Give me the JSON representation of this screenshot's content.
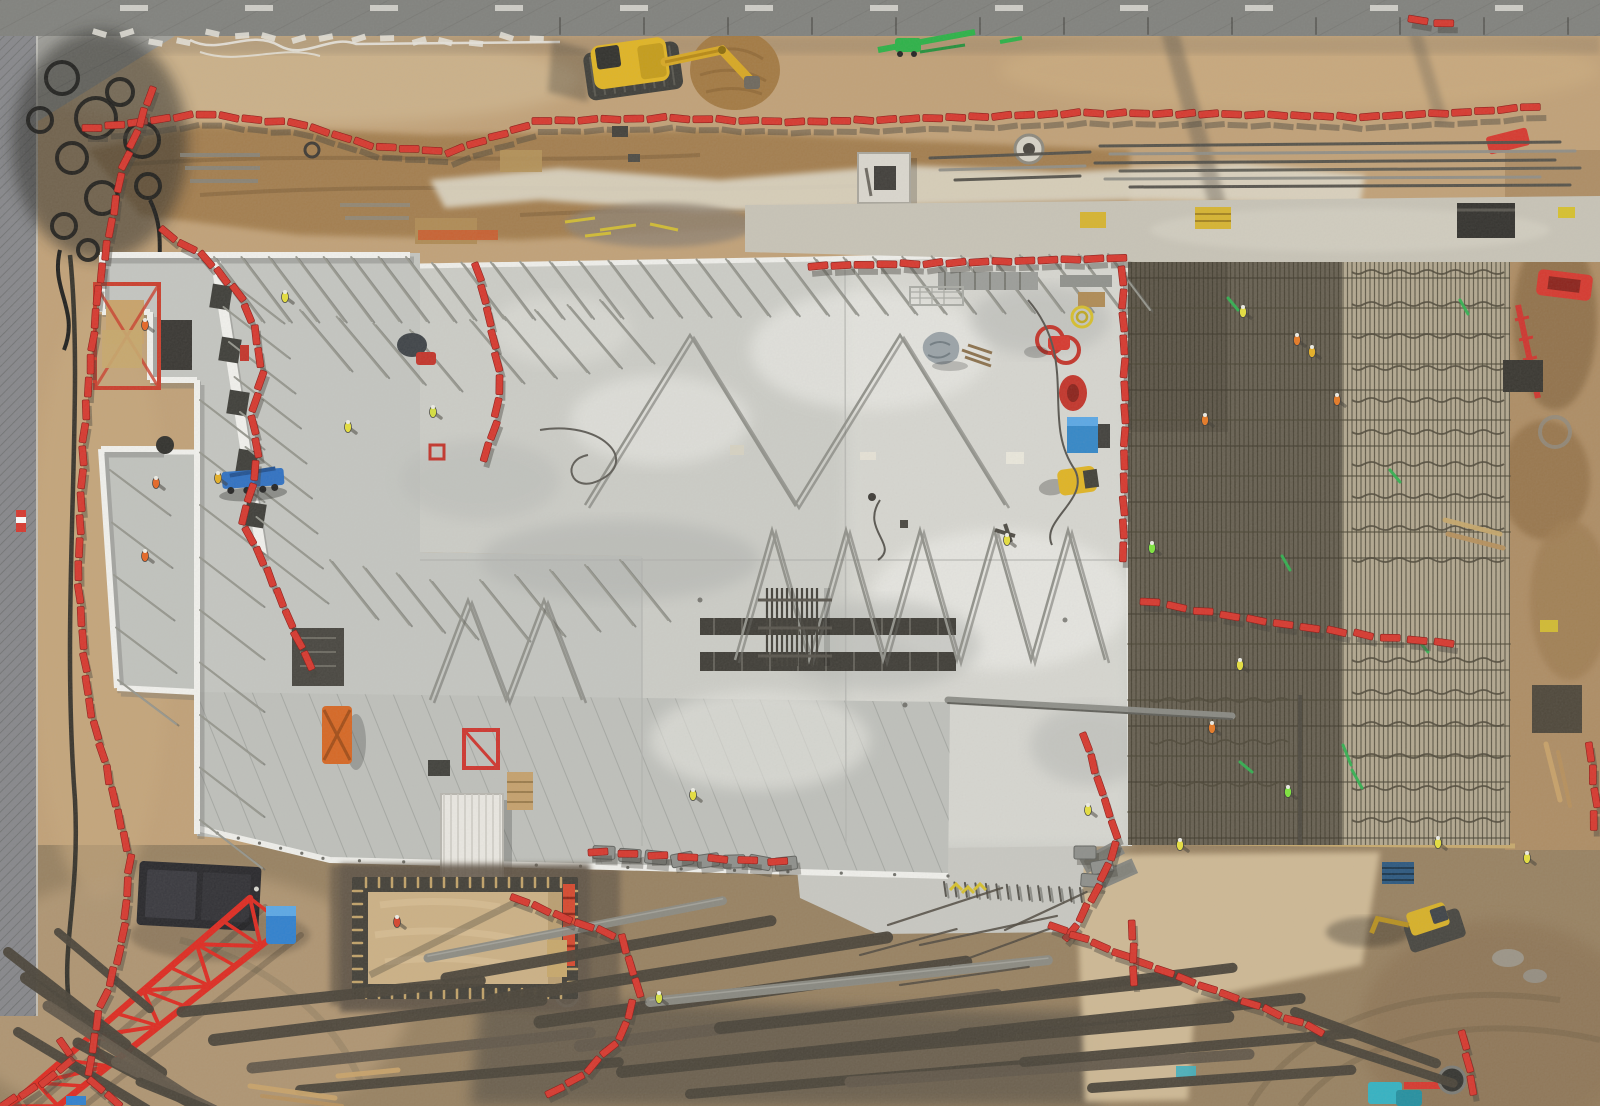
{
  "scene": {
    "title": "Aerial drone view of a construction site",
    "type": "top-down photograph",
    "width": 1600,
    "height": 1106,
    "elements": [
      "road",
      "perimeter-fence",
      "dirt-groundworks",
      "excavation-trench",
      "yellow-excavator",
      "black-cable-coils",
      "red-barrier-chains",
      "precast-building-shell",
      "prop-braces",
      "fresh-concrete-slab",
      "rebar-mesh-pour-area",
      "white-container",
      "blue-telehandler",
      "crawler-crane-boom",
      "foundation-pit-formwork",
      "rebar-stockpiles",
      "mini-excavator",
      "workers-hi-vis"
    ]
  },
  "colors": {
    "dirt_base": "#c2a176",
    "dirt_dark": "#9c7a4e",
    "dirt_brown": "#8a6a42",
    "mud": "#6a5d4b",
    "sand_light": "#d7c19a",
    "chalk": "#ded8c6",
    "road": "#7f807c",
    "fence": "#85868a",
    "slab": "#cdcec8",
    "slab_light": "#e6e6e0",
    "building_floor": "#c5c7c2",
    "canopy": "#bfc1bc",
    "wall_white": "#f4f4f0",
    "mesh_base": "#8a8171",
    "mesh_line": "#4b4534",
    "mesh_dark": "#2f2a1e",
    "mesh_light": "#cfc3a4",
    "barrier_red": "#d8342a",
    "crane_red": "#e0261c",
    "machine_yellow": "#e2b51f",
    "green": "#2eb24e",
    "blue": "#2b6fc4",
    "teal": "#2fb3c4",
    "dark": "#2e2c28",
    "steel": "#8a8a82",
    "shadow": "#3e3b35"
  },
  "road": {
    "dash_y": 5,
    "dash_xs": [
      120,
      245,
      370,
      495,
      620,
      745,
      870,
      995,
      1120,
      1245,
      1370,
      1495
    ]
  },
  "chains": [
    {
      "name": "perimeter-top",
      "sh": [
        6,
        10
      ],
      "pts": [
        [
          92,
          128
        ],
        [
          200,
          114
        ],
        [
          300,
          124
        ],
        [
          372,
          146
        ],
        [
          450,
          152
        ],
        [
          540,
          121
        ],
        [
          660,
          118
        ],
        [
          800,
          122
        ],
        [
          940,
          118
        ],
        [
          1080,
          113
        ],
        [
          1220,
          114
        ],
        [
          1360,
          117
        ],
        [
          1470,
          112
        ],
        [
          1532,
          107
        ]
      ]
    },
    {
      "name": "perimeter-left",
      "pts": [
        [
          150,
          96
        ],
        [
          122,
          170
        ],
        [
          98,
          290
        ],
        [
          84,
          430
        ],
        [
          78,
          580
        ],
        [
          88,
          700
        ],
        [
          112,
          790
        ],
        [
          130,
          860
        ],
        [
          122,
          946
        ],
        [
          98,
          1016
        ],
        [
          88,
          1078
        ],
        [
          116,
          1102
        ]
      ]
    },
    {
      "name": "slab-north-east",
      "pts": [
        [
          818,
          266
        ],
        [
          980,
          262
        ],
        [
          1122,
          258
        ],
        [
          1125,
          400
        ],
        [
          1123,
          556
        ]
      ]
    },
    {
      "name": "slab-inner-west",
      "pts": [
        [
          478,
          272
        ],
        [
          492,
          330
        ],
        [
          500,
          380
        ],
        [
          494,
          430
        ],
        [
          486,
          452
        ]
      ]
    },
    {
      "name": "building-west",
      "pts": [
        [
          168,
          234
        ],
        [
          205,
          258
        ],
        [
          240,
          295
        ],
        [
          255,
          330
        ],
        [
          262,
          375
        ],
        [
          252,
          415
        ],
        [
          258,
          455
        ],
        [
          250,
          495
        ],
        [
          242,
          522
        ],
        [
          262,
          560
        ],
        [
          282,
          602
        ],
        [
          300,
          645
        ],
        [
          318,
          680
        ]
      ]
    },
    {
      "name": "slab-south",
      "step": 30,
      "pts": [
        [
          598,
          852
        ],
        [
          700,
          858
        ],
        [
          788,
          862
        ]
      ]
    },
    {
      "name": "slab-se-corner",
      "pts": [
        [
          1086,
          742
        ],
        [
          1102,
          792
        ],
        [
          1118,
          840
        ],
        [
          1096,
          892
        ],
        [
          1066,
          940
        ]
      ]
    },
    {
      "name": "bottom-diagonal",
      "pts": [
        [
          1058,
          928
        ],
        [
          1130,
          958
        ],
        [
          1200,
          985
        ],
        [
          1268,
          1010
        ],
        [
          1322,
          1032
        ]
      ]
    },
    {
      "name": "bottom-right-vertical",
      "pts": [
        [
          1464,
          1040
        ],
        [
          1470,
          1074
        ],
        [
          1475,
          1104
        ]
      ]
    },
    {
      "name": "mesh-mid",
      "step": 27,
      "pts": [
        [
          1150,
          602
        ],
        [
          1230,
          616
        ],
        [
          1310,
          628
        ],
        [
          1392,
          638
        ],
        [
          1470,
          645
        ]
      ]
    },
    {
      "name": "pit-east",
      "pts": [
        [
          520,
          900
        ],
        [
          575,
          922
        ],
        [
          622,
          938
        ],
        [
          638,
          988
        ],
        [
          620,
          1038
        ],
        [
          584,
          1074
        ],
        [
          546,
          1096
        ]
      ]
    },
    {
      "name": "corner-bottom-left",
      "pts": [
        [
          8,
          1102
        ],
        [
          42,
          1084
        ],
        [
          72,
          1060
        ],
        [
          54,
          1028
        ]
      ]
    },
    {
      "name": "top-right-single",
      "step": 26,
      "pts": [
        [
          1418,
          20
        ],
        [
          1450,
          24
        ]
      ]
    },
    {
      "name": "right-edge",
      "pts": [
        [
          1590,
          752
        ],
        [
          1596,
          800
        ],
        [
          1592,
          836
        ]
      ]
    },
    {
      "name": "apron-vertical",
      "pts": [
        [
          1132,
          930
        ],
        [
          1134,
          962
        ],
        [
          1133,
          992
        ]
      ]
    }
  ],
  "gray_barriers": [
    [
      604,
      852
    ],
    [
      630,
      855
    ],
    [
      656,
      857
    ],
    [
      682,
      859
    ],
    [
      708,
      860
    ],
    [
      734,
      861
    ],
    [
      760,
      862
    ],
    [
      786,
      863
    ],
    [
      1085,
      852
    ],
    [
      1102,
      866
    ],
    [
      1092,
      880
    ]
  ],
  "workers": [
    [
      285,
      297,
      "#e8e13a"
    ],
    [
      348,
      427,
      "#e8e13a"
    ],
    [
      433,
      412,
      "#d8e23c"
    ],
    [
      145,
      325,
      "#e86420"
    ],
    [
      156,
      483,
      "#e86420"
    ],
    [
      145,
      556,
      "#e86420"
    ],
    [
      218,
      478,
      "#e8b020"
    ],
    [
      693,
      795,
      "#e8e13a"
    ],
    [
      1007,
      540,
      "#e8e13a"
    ],
    [
      659,
      998,
      "#d8e23c"
    ],
    [
      397,
      922,
      "#d84028"
    ],
    [
      1243,
      312,
      "#e8e13a"
    ],
    [
      1297,
      340,
      "#e87820"
    ],
    [
      1312,
      352,
      "#e8b020"
    ],
    [
      1205,
      420,
      "#e87820"
    ],
    [
      1152,
      548,
      "#7ce838"
    ],
    [
      1240,
      665,
      "#e8e13a"
    ],
    [
      1212,
      728,
      "#e87820"
    ],
    [
      1288,
      792,
      "#7ce838"
    ],
    [
      1180,
      845,
      "#e8e13a"
    ],
    [
      1438,
      843,
      "#e8e13a"
    ],
    [
      1527,
      858,
      "#e8e13a"
    ],
    [
      1337,
      400,
      "#e87820"
    ],
    [
      1088,
      810,
      "#e8e13a"
    ]
  ],
  "bundles": [
    [
      8,
      952,
      150,
      38,
      10,
      "d"
    ],
    [
      26,
      978,
      165,
      35,
      12,
      "d"
    ],
    [
      48,
      1006,
      170,
      33,
      11,
      "b"
    ],
    [
      18,
      1032,
      150,
      31,
      10,
      "d"
    ],
    [
      78,
      1043,
      160,
      28,
      11,
      "d"
    ],
    [
      116,
      1062,
      150,
      26,
      10,
      "b"
    ],
    [
      58,
      932,
      120,
      40,
      8,
      "d"
    ],
    [
      140,
      1082,
      130,
      22,
      9,
      "d"
    ],
    [
      182,
      1012,
      300,
      -6,
      11,
      "d"
    ],
    [
      214,
      1040,
      330,
      -7,
      12,
      "d"
    ],
    [
      252,
      1068,
      340,
      -6,
      11,
      "b"
    ],
    [
      300,
      1090,
      320,
      -5,
      10,
      "d"
    ],
    [
      428,
      958,
      300,
      -11,
      9,
      "s"
    ],
    [
      446,
      978,
      330,
      -10,
      11,
      "d"
    ],
    [
      492,
      1000,
      400,
      -9,
      12,
      "d"
    ],
    [
      540,
      1022,
      430,
      -8,
      13,
      "d"
    ],
    [
      580,
      1046,
      420,
      -7,
      12,
      "b"
    ],
    [
      622,
      1072,
      390,
      -6,
      12,
      "d"
    ],
    [
      690,
      1094,
      340,
      -5,
      10,
      "d"
    ],
    [
      650,
      1002,
      400,
      -6,
      10,
      "s"
    ],
    [
      720,
      1028,
      460,
      -6,
      12,
      "d"
    ],
    [
      780,
      1056,
      450,
      -5,
      12,
      "d"
    ],
    [
      850,
      1082,
      400,
      -4,
      11,
      "b"
    ],
    [
      905,
      1008,
      330,
      -7,
      10,
      "d"
    ],
    [
      962,
      1034,
      340,
      -6,
      11,
      "d"
    ],
    [
      1024,
      1062,
      330,
      -5,
      10,
      "d"
    ],
    [
      1092,
      1088,
      260,
      -4,
      10,
      "d"
    ],
    [
      1295,
      1012,
      150,
      20,
      10,
      "d"
    ],
    [
      1320,
      1040,
      140,
      18,
      9,
      "d"
    ]
  ],
  "singles": [
    [
      888,
      925,
      120,
      -18
    ],
    [
      920,
      945,
      140,
      -12
    ],
    [
      950,
      965,
      110,
      -20
    ],
    [
      900,
      985,
      130,
      -8
    ],
    [
      860,
      955,
      100,
      -15
    ],
    [
      1005,
      930,
      90,
      -25
    ]
  ],
  "planks": [
    [
      250,
      1086,
      335,
      1098,
      5,
      "#caa368"
    ],
    [
      262,
      1096,
      342,
      1106,
      4,
      "#b8905a"
    ],
    [
      338,
      1076,
      398,
      1070,
      5,
      "#caa368"
    ],
    [
      1546,
      744,
      1560,
      800,
      5,
      "#caa368"
    ],
    [
      1558,
      752,
      1570,
      806,
      4,
      "#b8905a"
    ],
    [
      1445,
      520,
      1500,
      534,
      5,
      "#c8a86a"
    ],
    [
      1448,
      534,
      1503,
      548,
      5,
      "#b8905a"
    ]
  ],
  "beams": [
    [
      1100,
      146,
      1560,
      142,
      3,
      "#4e4c45"
    ],
    [
      1110,
      154,
      1575,
      151,
      3,
      "#8f8e86"
    ],
    [
      1095,
      163,
      1555,
      160,
      3,
      "#4e4c45"
    ],
    [
      1120,
      171,
      1580,
      168,
      3,
      "#5a584f"
    ],
    [
      1105,
      179,
      1540,
      177,
      3,
      "#8f8e86"
    ],
    [
      1130,
      187,
      1570,
      185,
      3,
      "#4e4c45"
    ],
    [
      930,
      158,
      1090,
      152,
      3,
      "#4e4c45"
    ],
    [
      940,
      170,
      1085,
      166,
      3,
      "#8f8e86"
    ],
    [
      955,
      180,
      1080,
      176,
      3,
      "#4e4c45"
    ],
    [
      948,
      700,
      1232,
      716,
      7,
      "#8a8b85"
    ],
    [
      948,
      703,
      1232,
      719,
      2,
      "#5b5b55"
    ]
  ],
  "prop_rows": [
    {
      "p0": [
        432,
        263
      ],
      "p1": [
        1108,
        254
      ],
      "n": 24,
      "dx": 42,
      "dy": 56
    },
    {
      "p0": [
        214,
        257
      ],
      "p1": [
        406,
        257
      ],
      "n": 8,
      "dx": 48,
      "dy": 64
    },
    {
      "p0": [
        218,
        272
      ],
      "p1": [
        262,
        552
      ],
      "n": 9,
      "dx": 64,
      "dy": 50
    },
    {
      "p0": [
        200,
        400
      ],
      "p1": [
        200,
        820
      ],
      "n": 9,
      "dx": 62,
      "dy": 48
    },
    {
      "p0": [
        110,
        470
      ],
      "p1": [
        118,
        680
      ],
      "n": 5,
      "dx": 58,
      "dy": 44
    },
    {
      "p0": [
        300,
        310
      ],
      "p1": [
        410,
        330
      ],
      "n": 4,
      "dx": 50,
      "dy": 60
    },
    {
      "p0": [
        330,
        560
      ],
      "p1": [
        430,
        580
      ],
      "n": 4,
      "dx": 46,
      "dy": 58
    },
    {
      "p0": [
        470,
        320
      ],
      "p1": [
        600,
        300
      ],
      "n": 5,
      "dx": 52,
      "dy": 62
    },
    {
      "p0": [
        480,
        580
      ],
      "p1": [
        620,
        560
      ],
      "n": 5,
      "dx": 48,
      "dy": 60
    },
    {
      "p0": [
        944,
        882
      ],
      "p1": [
        1080,
        888
      ],
      "n": 14,
      "dx": 2,
      "dy": 14,
      "c": "#4e4c45"
    }
  ],
  "zigzags": [
    [
      [
        735,
        660
      ],
      [
        772,
        530
      ],
      [
        809,
        660
      ],
      [
        846,
        530
      ],
      [
        883,
        660
      ],
      [
        920,
        530
      ],
      [
        957,
        660
      ],
      [
        994,
        530
      ],
      [
        1031,
        660
      ],
      [
        1068,
        530
      ],
      [
        1105,
        660
      ]
    ],
    [
      [
        585,
        505
      ],
      [
        690,
        335
      ],
      [
        795,
        505
      ],
      [
        900,
        335
      ],
      [
        1005,
        505
      ]
    ],
    [
      [
        430,
        700
      ],
      [
        468,
        600
      ],
      [
        506,
        700
      ],
      [
        544,
        600
      ],
      [
        582,
        700
      ]
    ]
  ],
  "squiggles": {
    "x0": 1352,
    "x1": 1504,
    "rows": [
      272,
      304,
      336,
      368,
      400,
      432,
      464,
      496,
      528,
      560,
      660,
      692,
      724,
      756,
      788,
      820
    ],
    "x0b": 1150,
    "x1b": 1292,
    "rows2": [
      700,
      742,
      784
    ]
  },
  "mesh_bands_ys": [
    308,
    364,
    420,
    476,
    532,
    644,
    700,
    756,
    812
  ],
  "greens": [
    [
      1343,
      745,
      1351,
      765
    ],
    [
      1352,
      770,
      1362,
      788
    ],
    [
      1228,
      298,
      1238,
      310
    ],
    [
      1282,
      556,
      1290,
      570
    ],
    [
      1418,
      640,
      1428,
      652
    ],
    [
      1460,
      300,
      1468,
      314
    ],
    [
      1240,
      762,
      1252,
      772
    ],
    [
      1390,
      470,
      1400,
      482
    ]
  ],
  "coils": [
    [
      62,
      78,
      16
    ],
    [
      96,
      118,
      20
    ],
    [
      72,
      158,
      15
    ],
    [
      120,
      92,
      13
    ],
    [
      142,
      140,
      17
    ],
    [
      102,
      198,
      16
    ],
    [
      64,
      226,
      12
    ],
    [
      148,
      186,
      12
    ],
    [
      88,
      250,
      10
    ],
    [
      40,
      120,
      12
    ]
  ],
  "rubble_xs": [
    92,
    120,
    150,
    178,
    205,
    235,
    262,
    290,
    318,
    350,
    380,
    410,
    440,
    470,
    500,
    530
  ],
  "pit": {
    "x": 352,
    "y": 877,
    "w": 226,
    "h": 122,
    "sand_inset": 15
  },
  "canopy_edge": [
    [
      196,
      828
    ],
    [
      330,
      860
    ],
    [
      610,
      867
    ],
    [
      948,
      876
    ]
  ]
}
